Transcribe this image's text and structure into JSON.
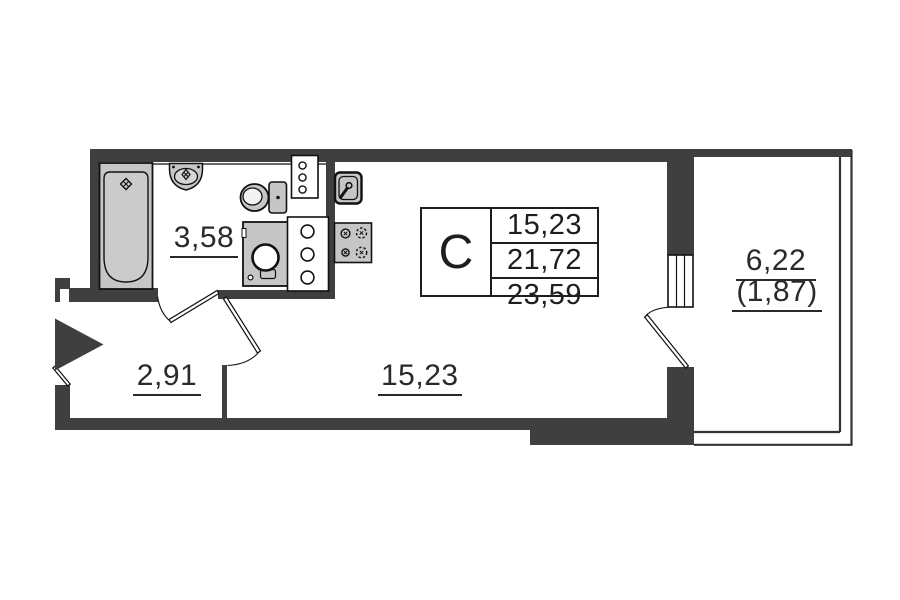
{
  "plan": {
    "type_label": "С",
    "area_rows": [
      "15,23",
      "21,72",
      "23,59"
    ],
    "rooms": [
      {
        "id": "bathroom",
        "area": "3,58"
      },
      {
        "id": "hallway",
        "area": "2,91"
      },
      {
        "id": "living-room",
        "area": "15,23"
      },
      {
        "id": "balcony",
        "area": "6,22",
        "area_reduced": "(1,87)"
      }
    ],
    "fixtures": [
      "bathtub",
      "bath-sink",
      "toilet",
      "washing-machine",
      "ventilation-shaft",
      "kitchen-sink",
      "stove",
      "entrance-arrow",
      "window",
      "balcony-door",
      "interior-door",
      "bathroom-door",
      "entrance-door"
    ],
    "colors": {
      "wall": "#3f3f3f",
      "fixture": "#c6c6c6",
      "line": "#111111",
      "text": "#2a2a2a",
      "background": "#ffffff"
    }
  }
}
